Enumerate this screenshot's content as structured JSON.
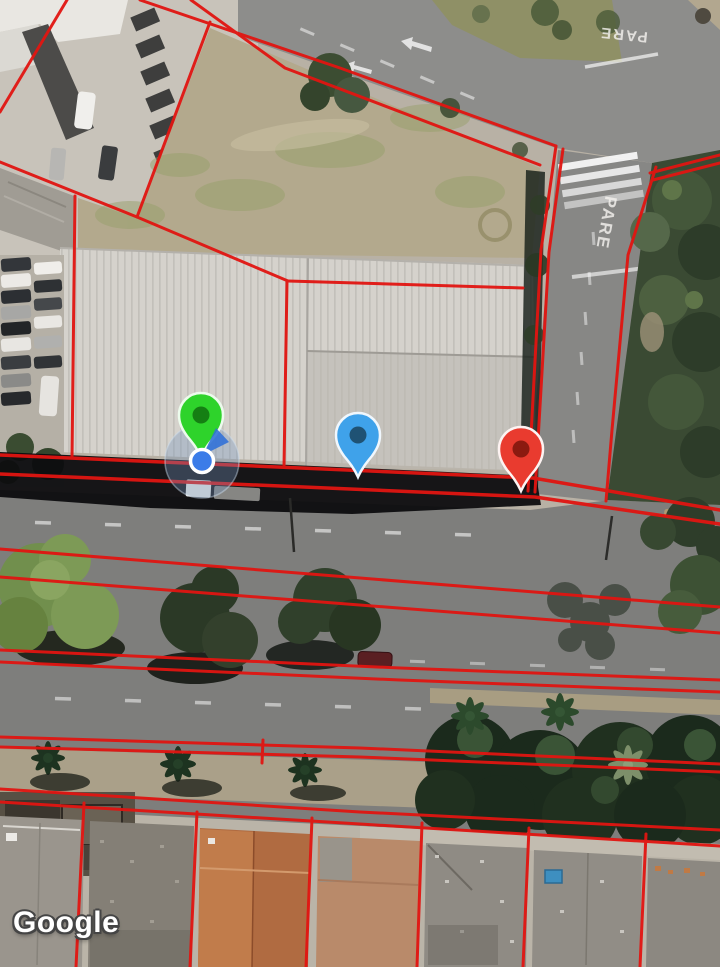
{
  "map": {
    "watermark": "Google",
    "road_markings": {
      "pare_intersection": "PARE",
      "pare_top": "PARE"
    },
    "overlay": {
      "name": "parcel-boundary-overlay",
      "parcel_line_color": "#e11511"
    },
    "markers": {
      "green": {
        "label": "green-marker",
        "color": "#2ed32b",
        "inner_color": "#157f13",
        "outline": "#ecfbec"
      },
      "blue": {
        "label": "blue-marker",
        "color": "#3fa2ea",
        "inner_color": "#1f5274",
        "outline": "#f0f7fd"
      },
      "red": {
        "label": "red-marker",
        "color": "#e93b2f",
        "inner_color": "#8b1a10",
        "outline": "#fdf3f2"
      }
    },
    "user_location": {
      "dot_color": "#3b7ce8",
      "ring_color": "#ffffff",
      "accuracy_fill": "rgba(118,148,188,0.35)",
      "accuracy_stroke": "rgba(205,222,240,0.45)",
      "heading_color": "#2f6fd8"
    }
  }
}
